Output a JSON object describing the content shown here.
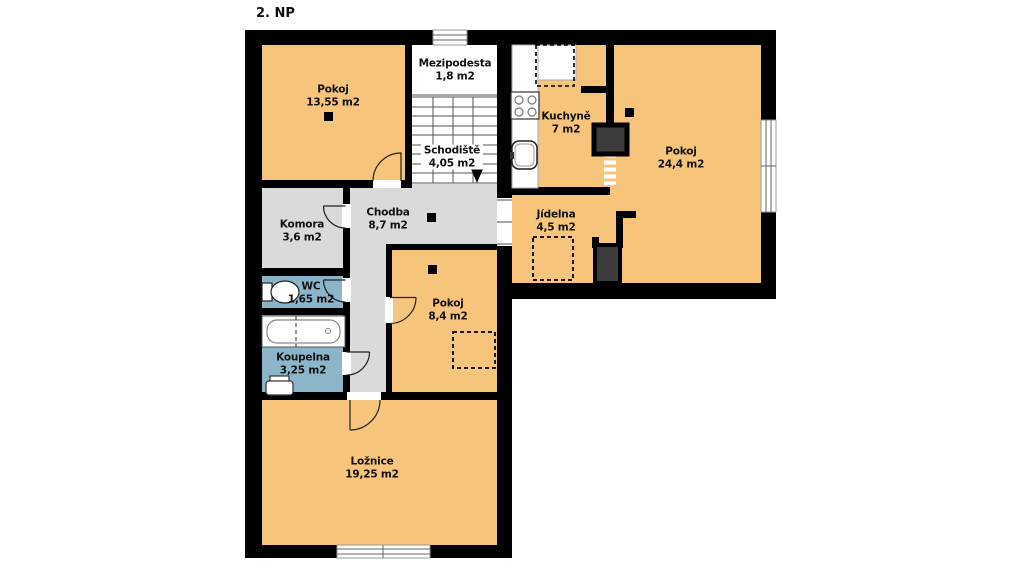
{
  "title": "2. NP",
  "colors": {
    "room": "#F6C57B",
    "hall": "#DADADA",
    "bath": "#8DB5CA",
    "wall": "#000000",
    "chimney": "#3C3C3C",
    "fixture_stroke": "#222222"
  },
  "rooms": [
    {
      "name": "Pokoj",
      "area": "13,55 m2"
    },
    {
      "name": "Mezipodesta",
      "area": "1,8 m2"
    },
    {
      "name": "Schodiště",
      "area": "4,05 m2"
    },
    {
      "name": "Kuchyně",
      "area": "7 m2"
    },
    {
      "name": "Pokoj",
      "area": "24,4 m2"
    },
    {
      "name": "Komora",
      "area": "3,6 m2"
    },
    {
      "name": "Chodba",
      "area": "8,7 m2"
    },
    {
      "name": "Jídelna",
      "area": "4,5 m2"
    },
    {
      "name": "WC",
      "area": "1,65 m2"
    },
    {
      "name": "Pokoj",
      "area": "8,4 m2"
    },
    {
      "name": "Koupelna",
      "area": "3,25 m2"
    },
    {
      "name": "Ložnice",
      "area": "19,25 m2"
    }
  ]
}
